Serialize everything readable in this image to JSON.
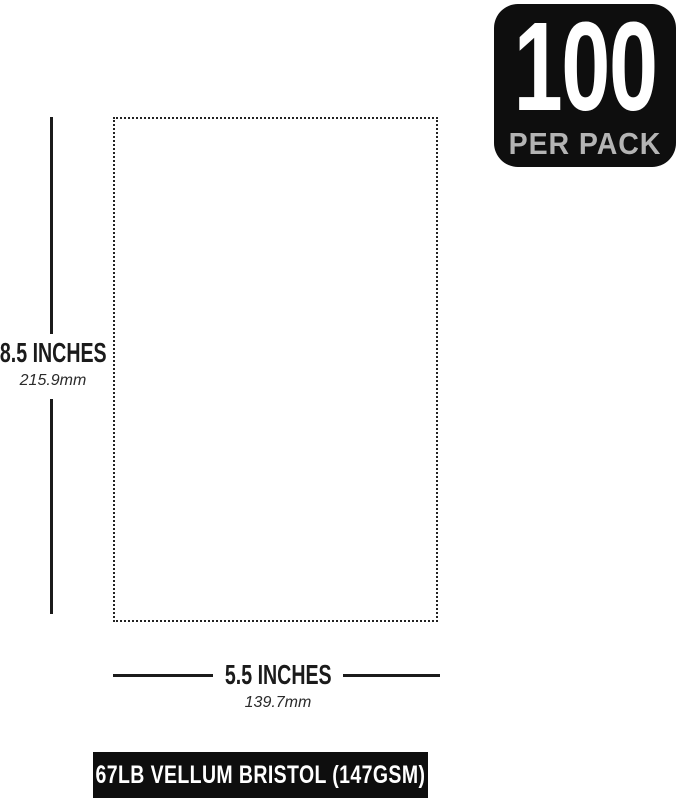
{
  "badge": {
    "count": "100",
    "label": "PER PACK",
    "bg_color": "#0e0e0e",
    "count_color": "#ffffff",
    "label_color": "#b4b4b4"
  },
  "paper": {
    "border_color": "#222222"
  },
  "height_measure": {
    "inches": "8.5 INCHES",
    "mm": "215.9mm"
  },
  "width_measure": {
    "inches": "5.5 INCHES",
    "mm": "139.7mm"
  },
  "footer": {
    "label": "67LB VELLUM BRISTOL (147GSM)",
    "bg_color": "#0e0e0e",
    "text_color": "#ffffff"
  }
}
